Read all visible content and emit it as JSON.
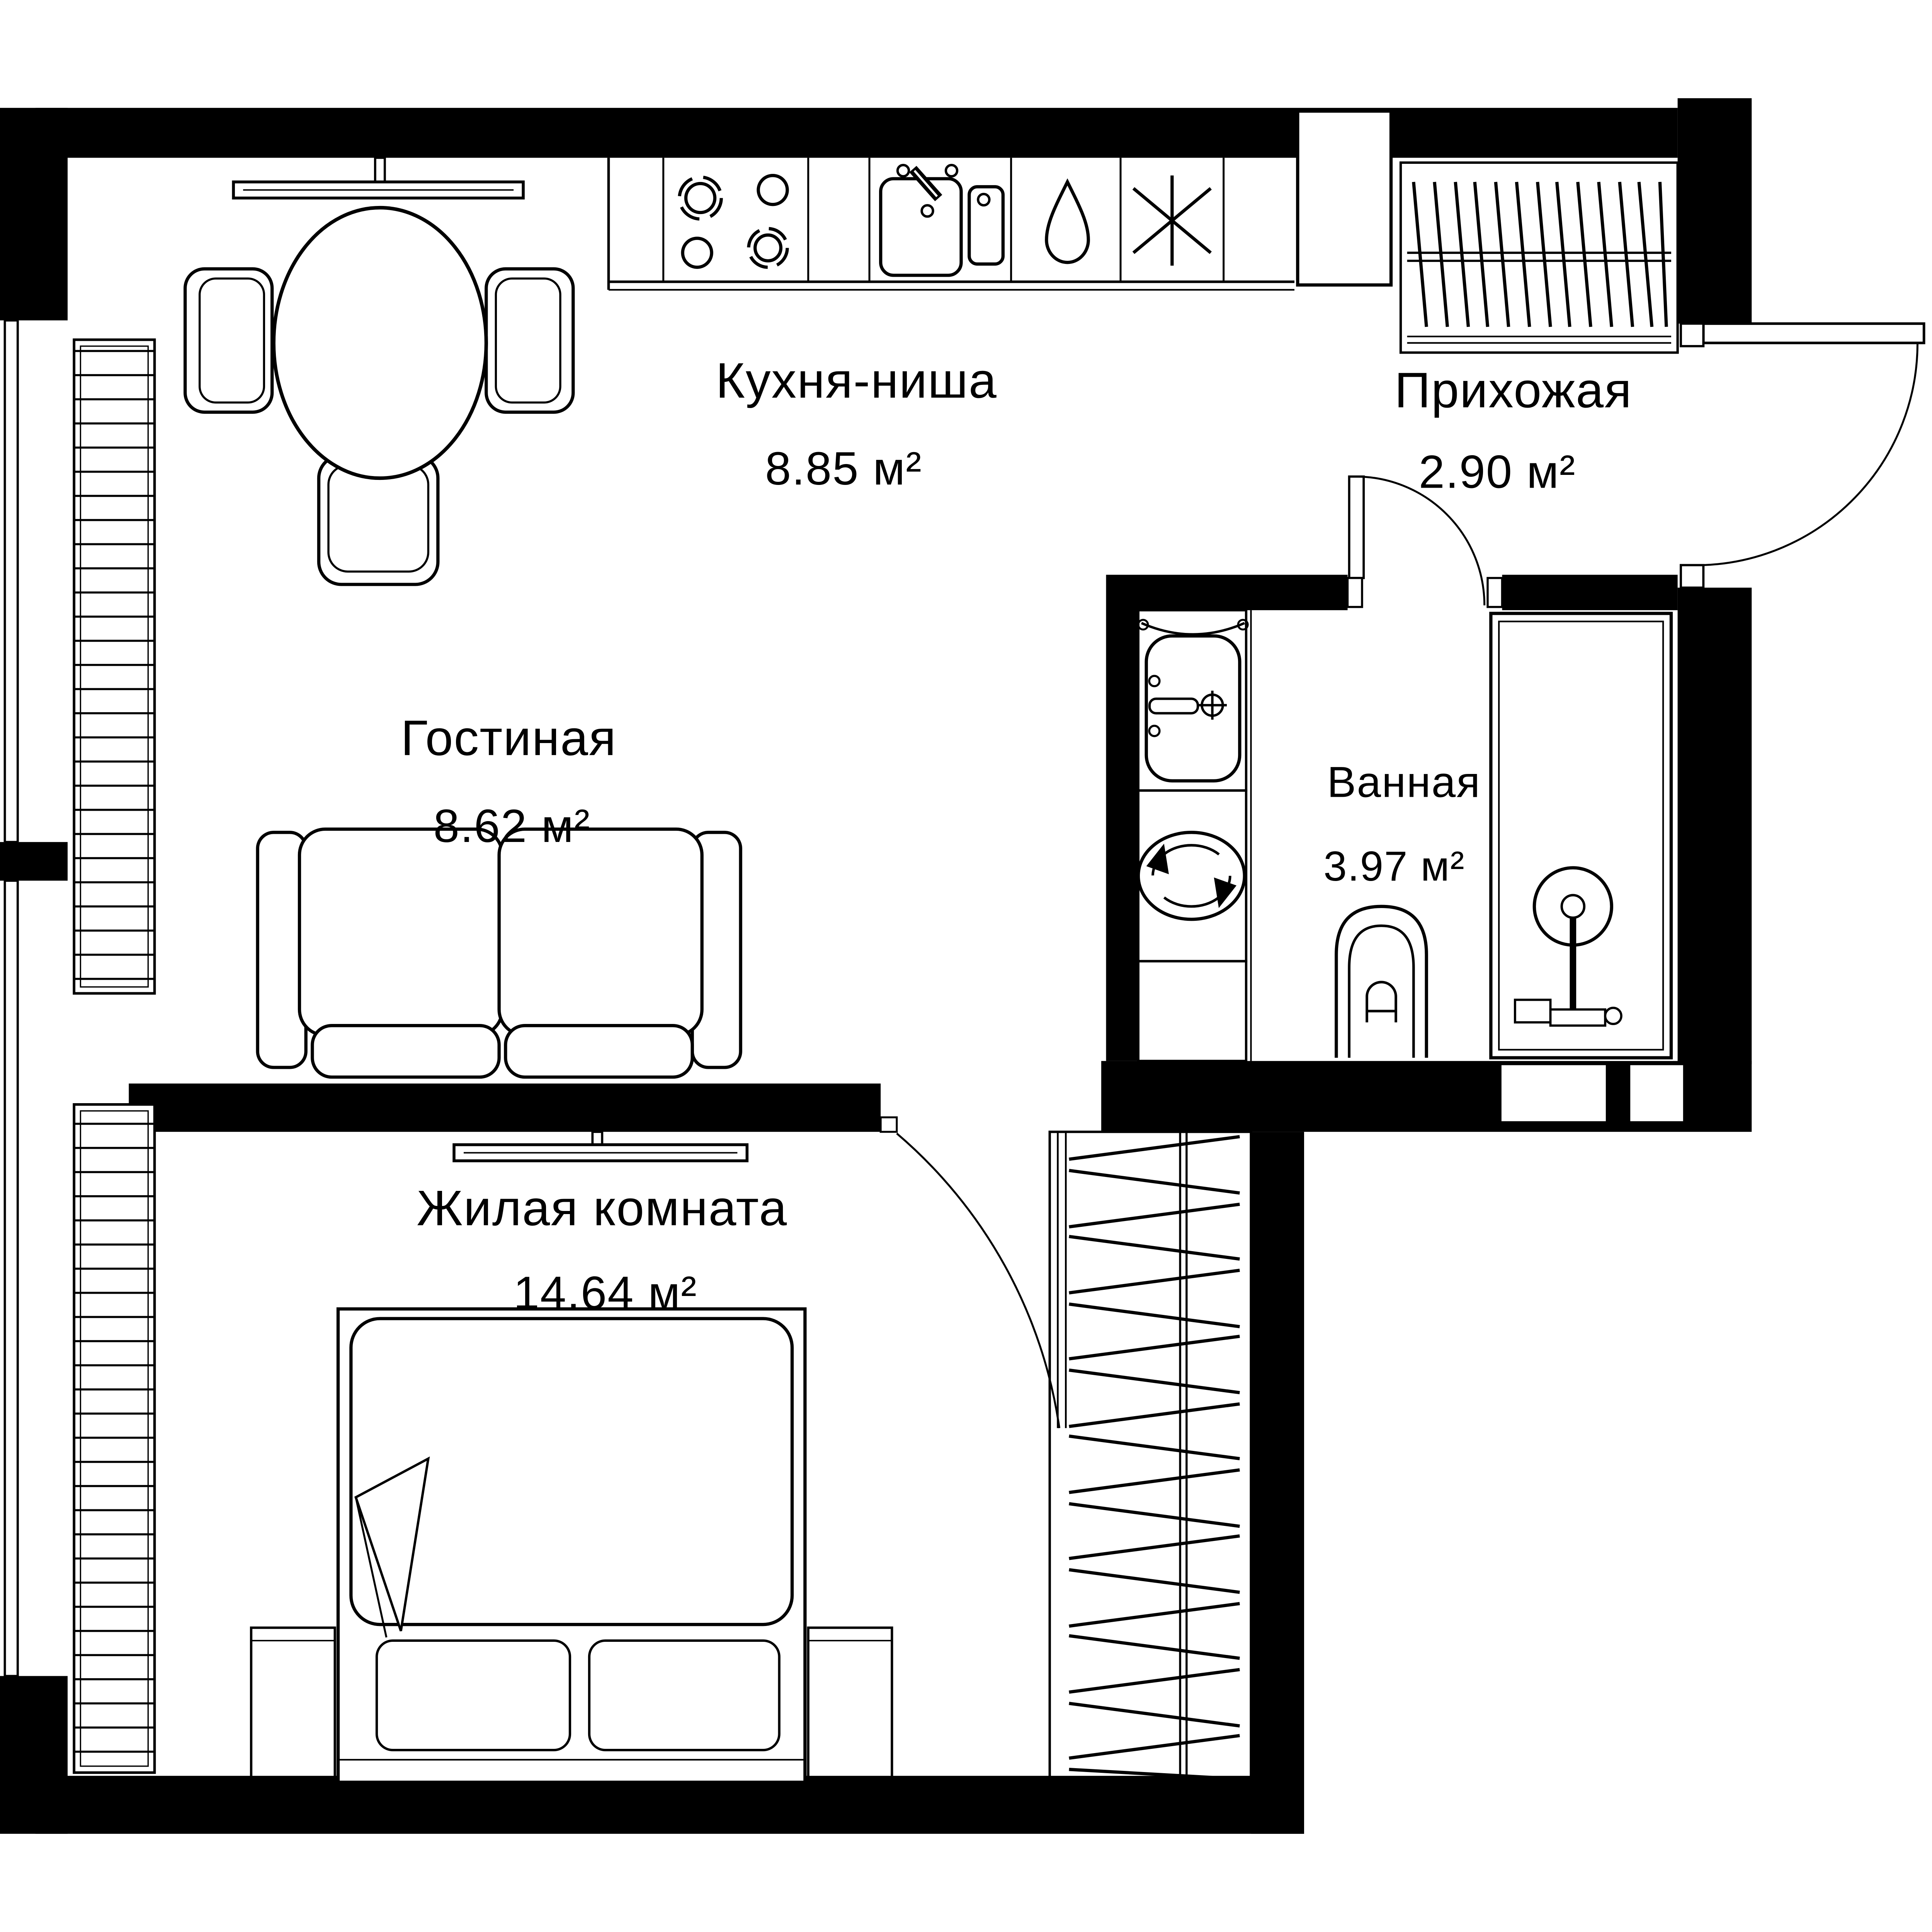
{
  "rooms": [
    {
      "id": "kitchen",
      "name": "Кухня-ниша",
      "area": "8.85 м²"
    },
    {
      "id": "hallway",
      "name": "Прихожая",
      "area": "2.90 м²"
    },
    {
      "id": "living",
      "name": "Гостиная",
      "area": "8.62 м²"
    },
    {
      "id": "bathroom",
      "name": "Ванная",
      "area": "3.97 м²"
    },
    {
      "id": "bedroom",
      "name": "Жилая комната",
      "area": "14.64 м²"
    }
  ],
  "colors": {
    "wall": "#000000",
    "background": "#ffffff",
    "line": "#000000"
  },
  "icons": [
    "hob-icon",
    "kitchen-sink-icon",
    "dishwasher-drop-icon",
    "fridge-snowflake-icon",
    "vent-shaft-icon",
    "dining-table-icon",
    "chair-icon",
    "wall-tv-icon",
    "sofa-icon",
    "radiator-icon",
    "window-icon",
    "door-swing-icon",
    "hanger-rail-icon",
    "bathroom-sink-icon",
    "washing-machine-icon",
    "toilet-icon",
    "shower-icon",
    "bed-icon",
    "nightstand-icon",
    "wardrobe-icon"
  ]
}
